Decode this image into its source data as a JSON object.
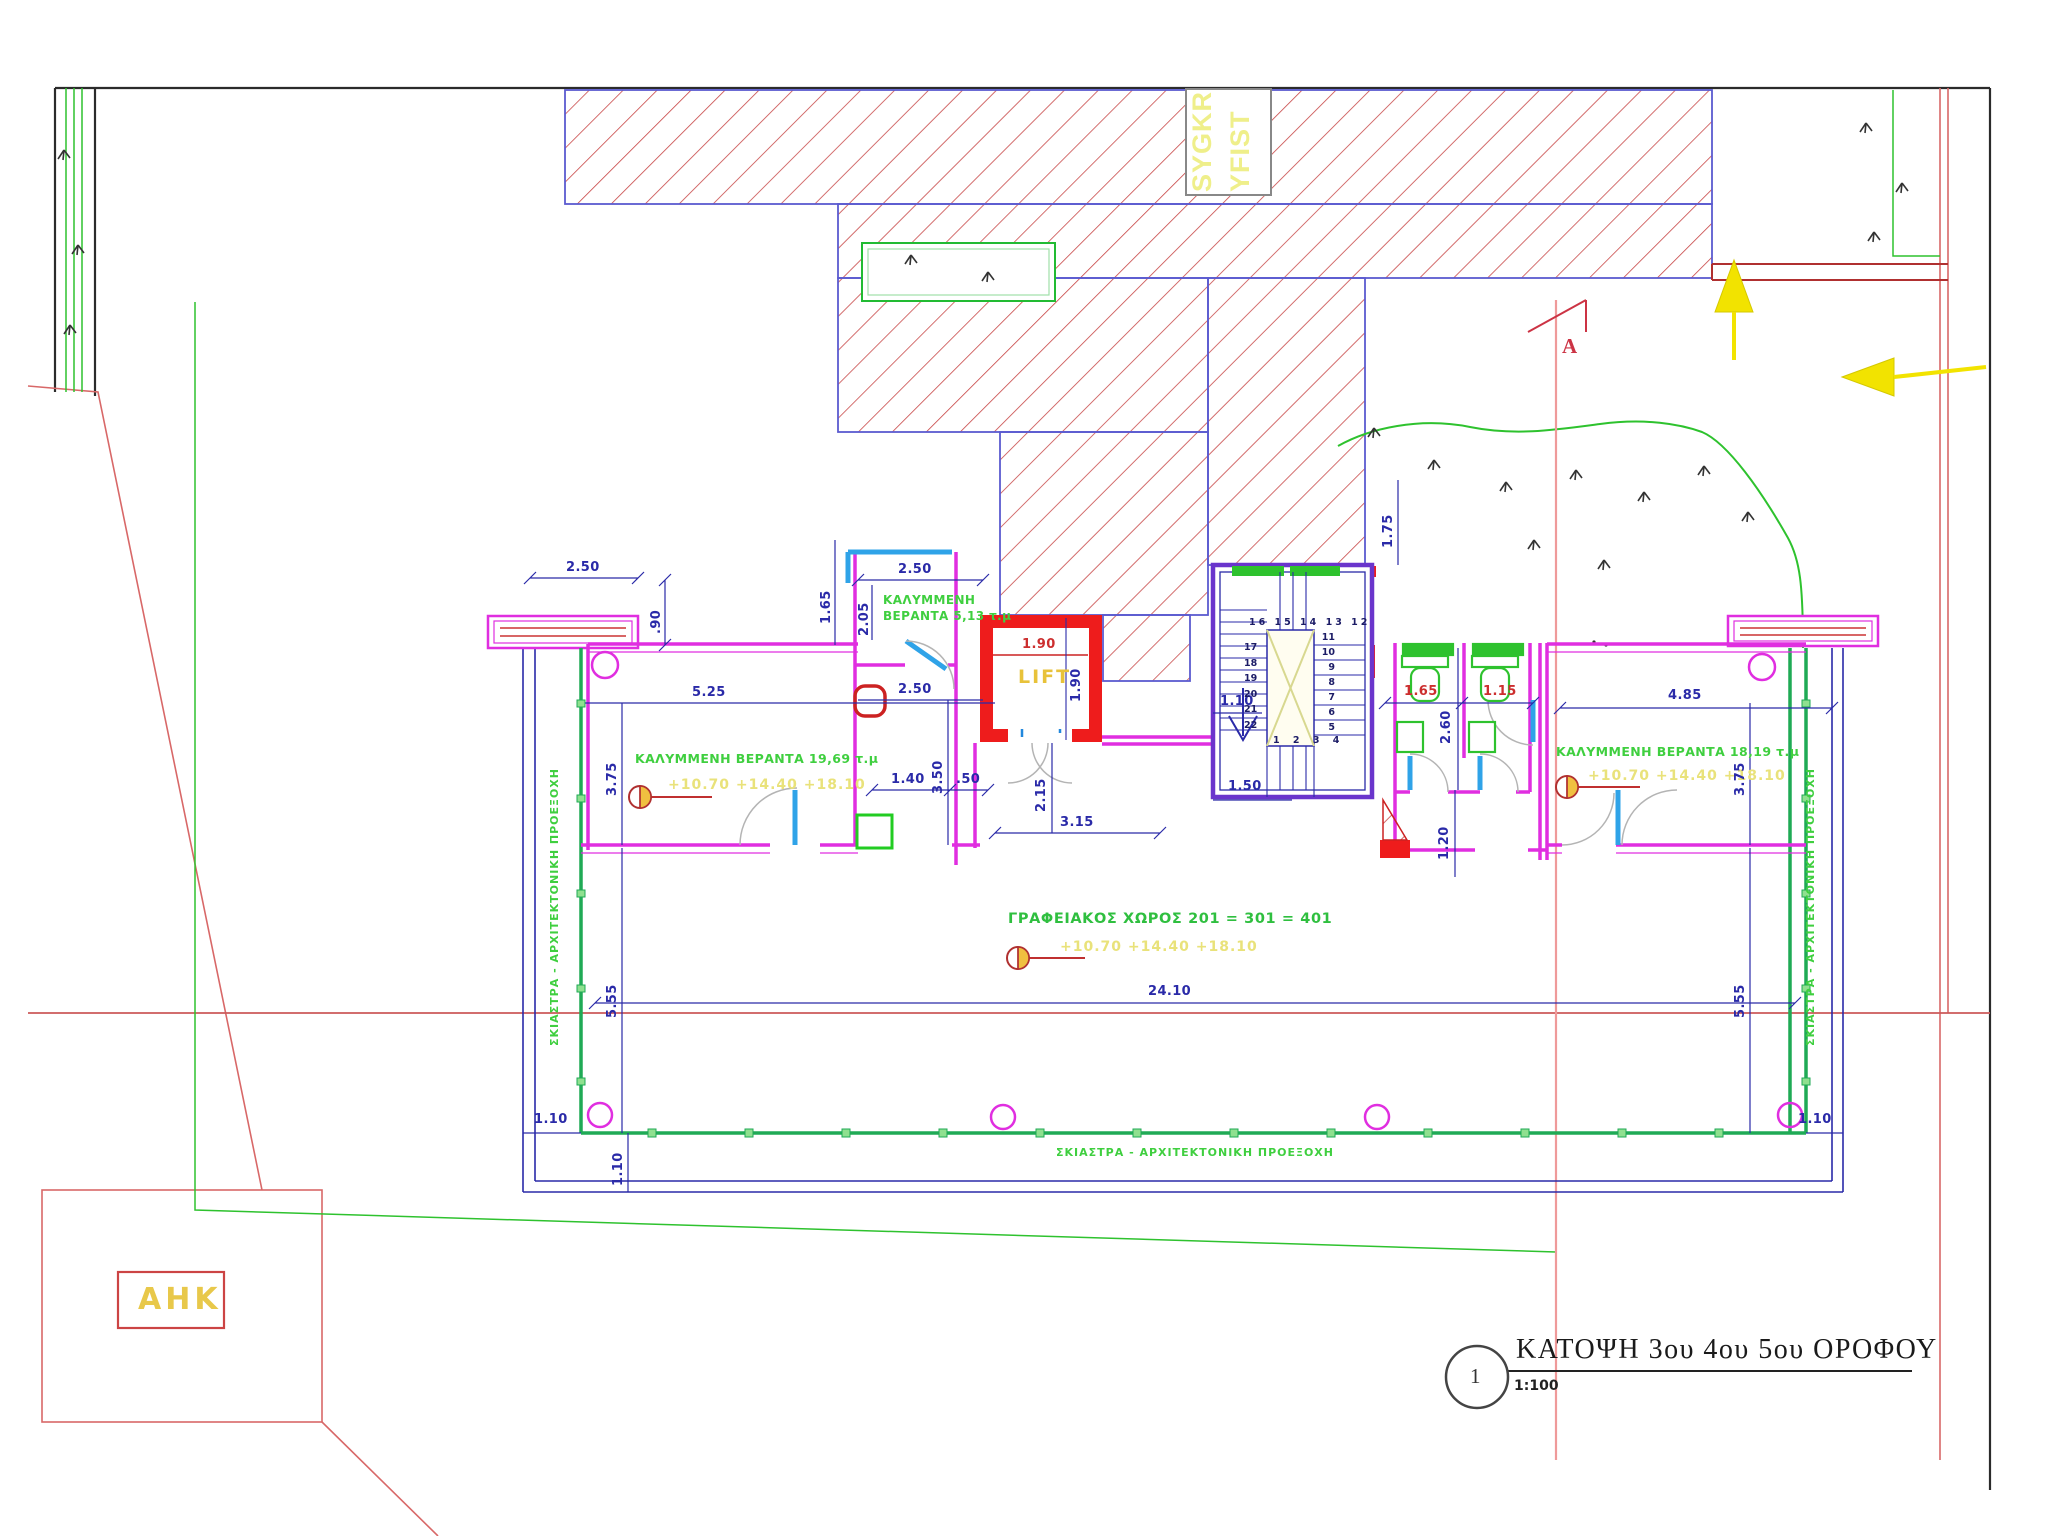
{
  "title_block": {
    "number": "1",
    "title": "ΚΑΤΟΨΗ 3ου 4ου 5ου  ΟΡΟΦΟΥ",
    "scale": "1:100"
  },
  "site": {
    "existing_label_line1": "SYGKR",
    "existing_label_line2": "YFIST",
    "ahk_label": "ΑΗΚ",
    "section_letter": "A"
  },
  "rooms": {
    "veranda_left": "ΚΑΛΥΜΜΕΝΗ ΒΕΡΑΝΤΑ 19,69 τ.μ",
    "veranda_small_1": "ΚΑΛΥΜΜΕΝΗ",
    "veranda_small_2": "ΒΕΡΑΝΤΑ 5,13 τ.μ",
    "veranda_right": "ΚΑΛΥΜΜΕΝΗ ΒΕΡΑΝΤΑ 18,19 τ.μ",
    "office": "ΓΡΑΦΕΙΑΚΟΣ ΧΩΡΟΣ  201 = 301 = 401",
    "lift": "LIFT",
    "levels": "+10.70  +14.40  +18.10",
    "shading": "ΣΚΙΑΣΤΡΑ - ΑΡΧΙΤΕΚΤΟΝΙΚΗ ΠΡΟΕΞΟΧΗ"
  },
  "dimensions": {
    "top_left_250": "2.50",
    "left_90": ".90",
    "left_165": "1.65",
    "veranda_top_250": "2.50",
    "veranda_205": "2.05",
    "lift_190_w": "1.90",
    "lift_190_h": "1.90",
    "mid_250": "2.50",
    "mid_350": "3.50",
    "mid_140": "1.40",
    "mid_50": ".50",
    "lobby_215": "2.15",
    "lobby_315": "3.15",
    "left_525": "5.25",
    "left_375": "3.75",
    "left_555": "5.55",
    "left_110": "1.10",
    "left_110_v": "1.10",
    "bottom_2410": "24.10",
    "right_175": "1.75",
    "stair_110": "1.10",
    "stair_150": "1.50",
    "wc_165": "1.65",
    "wc_115": "1.15",
    "wc_260": "2.60",
    "wc_120": "1.20",
    "right_485": "4.85",
    "right_375": "3.75",
    "right_555": "5.55",
    "right_110": "1.10"
  },
  "stairs": {
    "top_row": "16 15 14 13 12",
    "left_col": "17\n18\n19\n20\n21\n22",
    "right_col": "11\n10\n9\n8\n7\n6\n5",
    "bottom_row": "1 2 3 4"
  },
  "colors": {
    "wall_magenta": "#e02ee0",
    "dim_blue": "#2a2aa8",
    "hatch_red": "#c84848",
    "shaft_red": "#ee1c1c",
    "label_green": "#3fcf3f",
    "level_yellow": "#e9e27a",
    "arrow_yellow": "#f2e300",
    "boundary_red": "#d86868",
    "door_cyan": "#2fa3e8"
  }
}
